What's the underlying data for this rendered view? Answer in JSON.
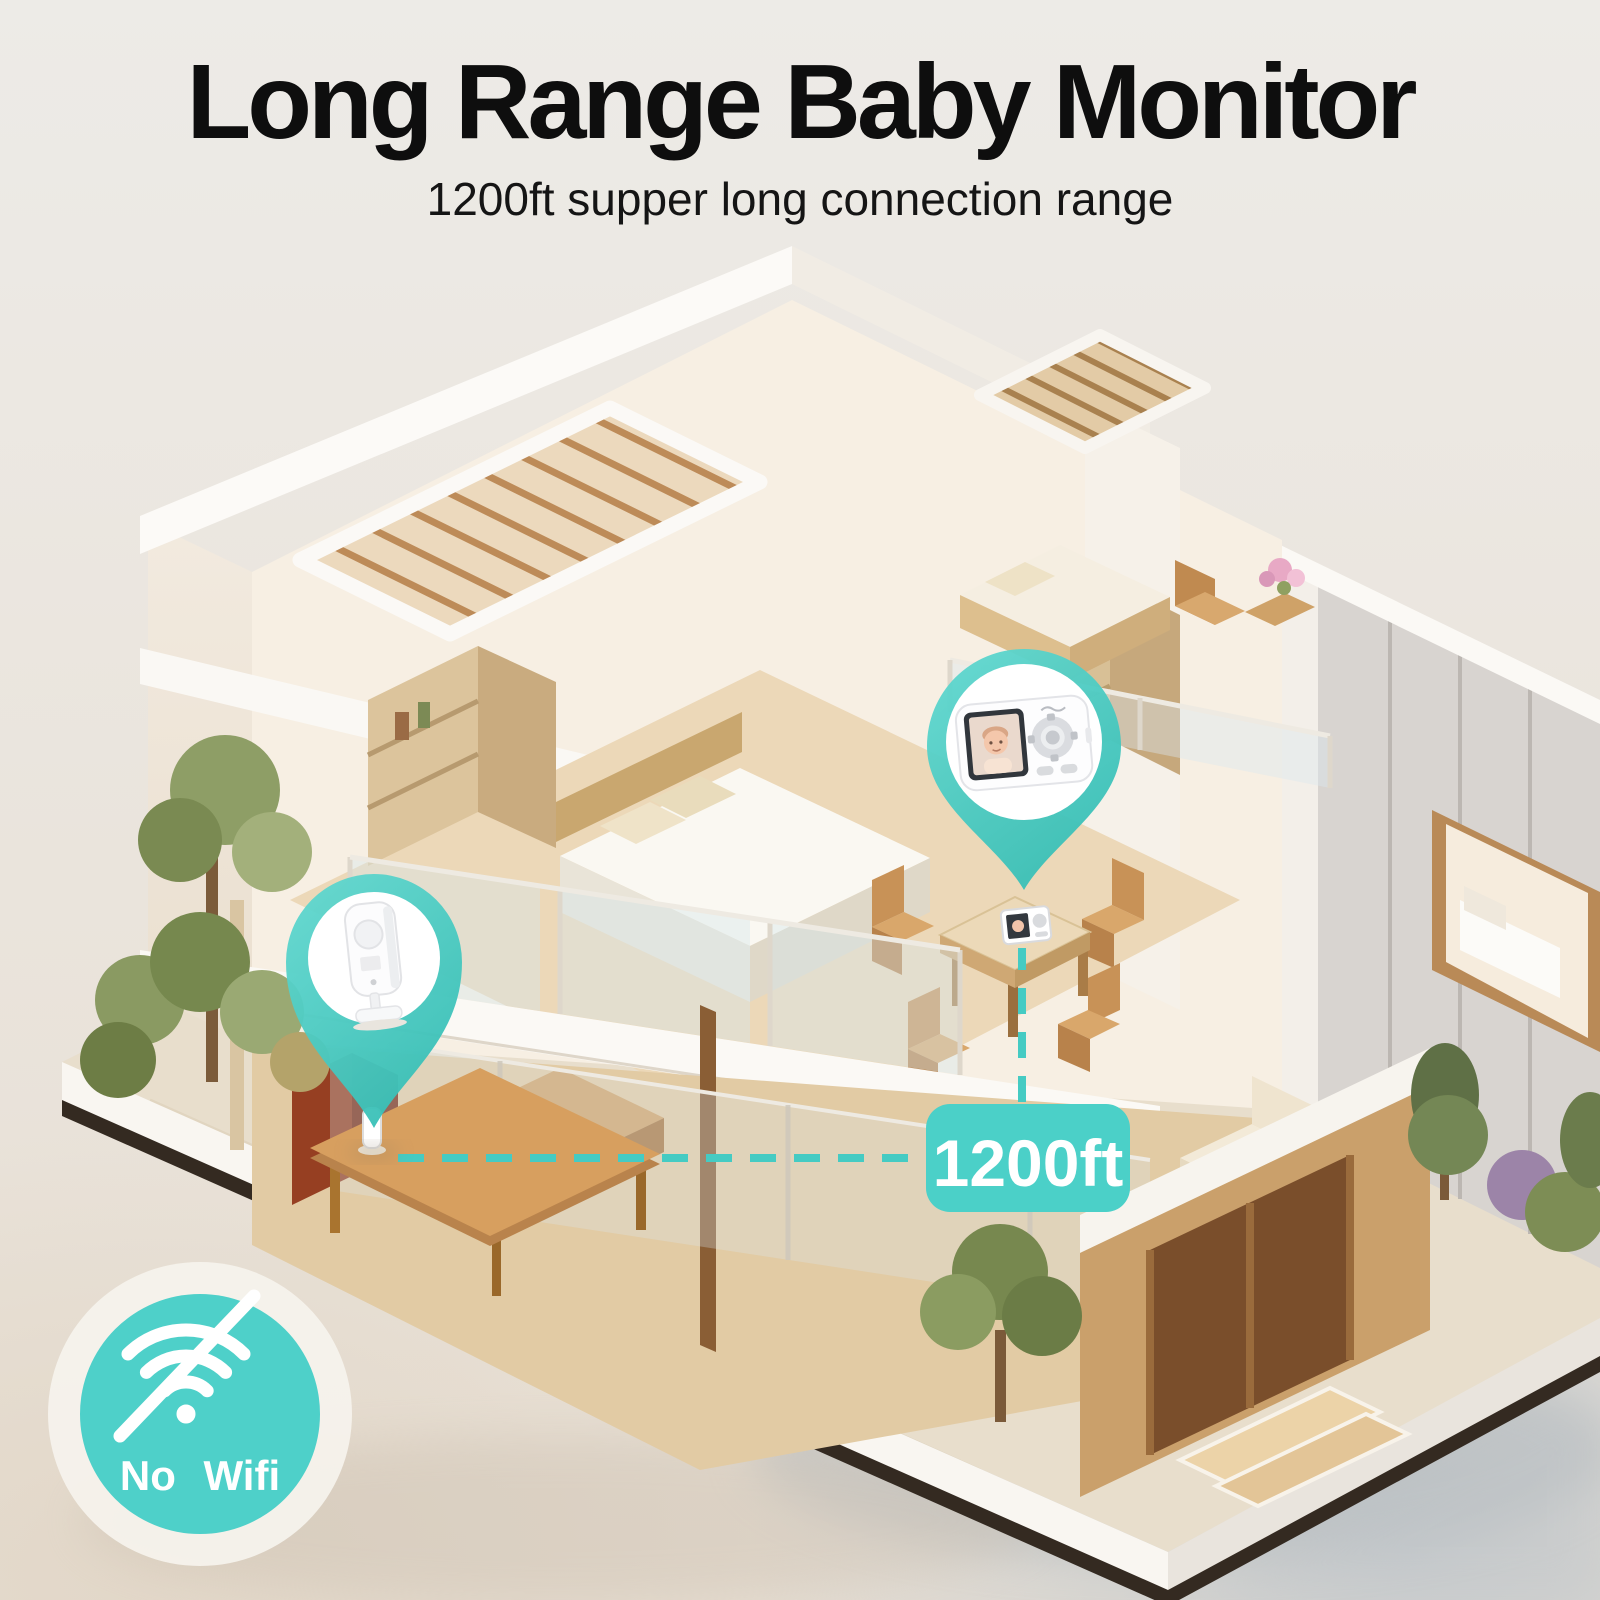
{
  "title": "Long Range Baby Monitor",
  "subtitle": "1200ft supper long connection range",
  "annotations": {
    "range_badge_label": "1200ft",
    "no_wifi_label": "No Wifi",
    "connection": {
      "from": "baby-camera",
      "to": "parent-monitor",
      "distance": "1200ft"
    }
  },
  "devices": [
    {
      "name": "baby-camera",
      "pin": "camera-location-pin",
      "placement": "coffee table, ground floor patio"
    },
    {
      "name": "parent-monitor",
      "pin": "monitor-location-pin",
      "placement": "dining table, upper floor",
      "screen": "baby video"
    }
  ],
  "icons": [
    "location-pin-icon",
    "wifi-off-icon"
  ],
  "scene": {
    "type": "isometric-cutaway-house",
    "floors": 2,
    "style": "white walls, wood interiors, trees"
  },
  "colors": {
    "accent_teal": "#4BD0C8",
    "badge_text": "#FFFFFF",
    "halo": "#F6F2EC",
    "title_text": "#0E0E0E",
    "background": "#EAE5DE"
  }
}
